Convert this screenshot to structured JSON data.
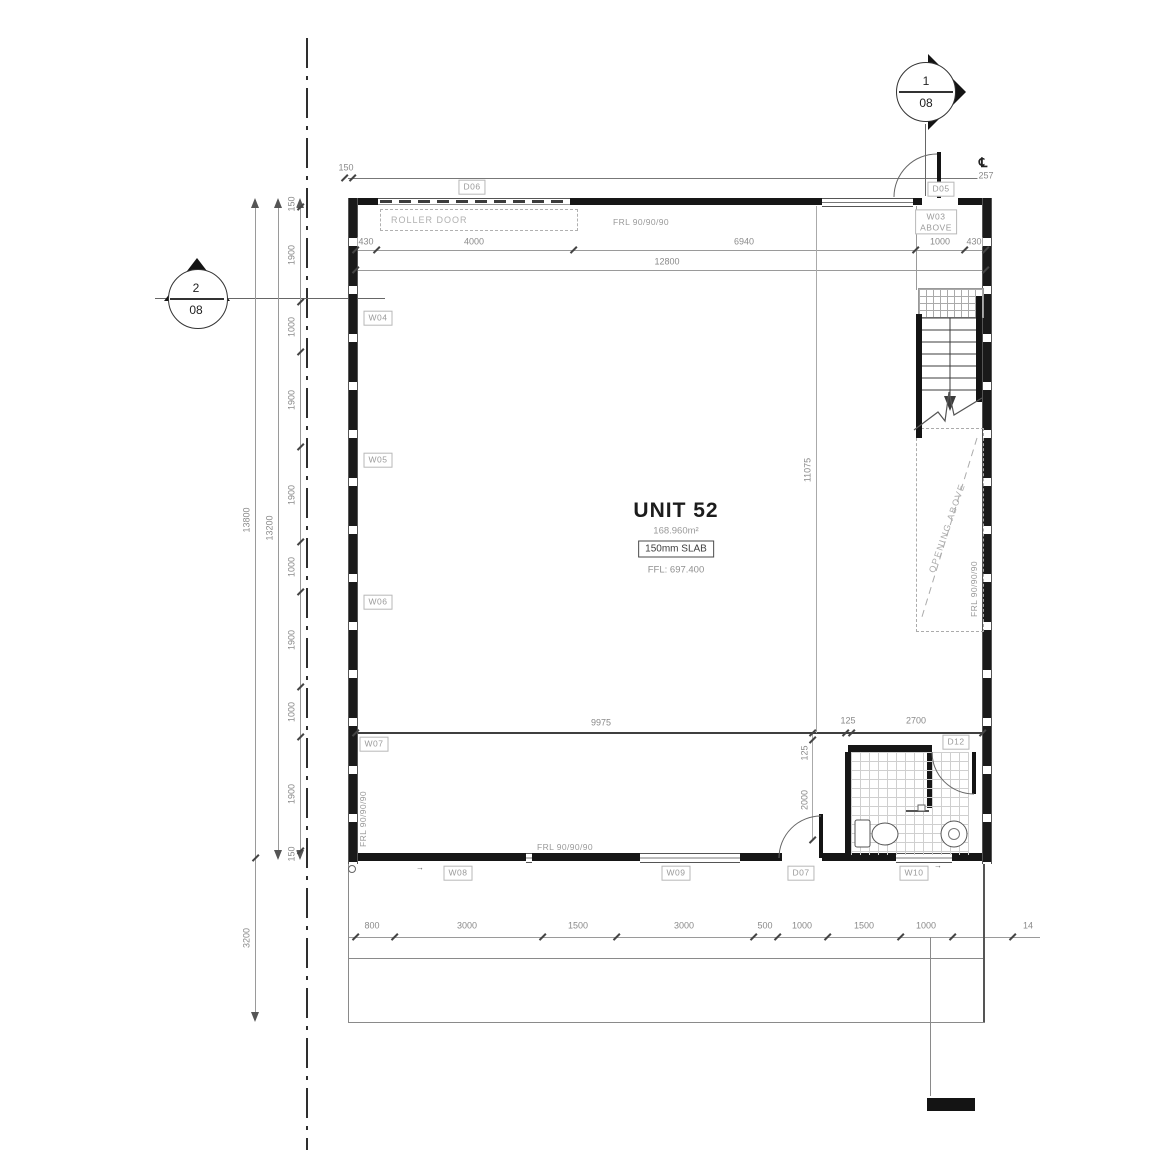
{
  "drawing": {
    "unit_name": "UNIT 52",
    "unit_area": "168.960m²",
    "slab_note": "150mm SLAB",
    "ffl_note": "FFL: 697.400",
    "roller_door": "ROLLER DOOR",
    "opening_above": "OPENING ABOVE",
    "centerline_symbol": "℄",
    "centerline_dim": "257",
    "frl_rating": "FRL 90/90/90"
  },
  "section_markers": {
    "top": {
      "number": "1",
      "sheet": "08"
    },
    "left": {
      "number": "2",
      "sheet": "08"
    }
  },
  "wall_tag_w03": {
    "text": "W03\nABOVE"
  },
  "tags": [
    {
      "id": "D06",
      "text": "D06",
      "x": 472,
      "y": 187
    },
    {
      "id": "D05",
      "text": "D05",
      "x": 941,
      "y": 189
    },
    {
      "id": "W04",
      "text": "W04",
      "x": 378,
      "y": 318
    },
    {
      "id": "W05",
      "text": "W05",
      "x": 378,
      "y": 460
    },
    {
      "id": "W06",
      "text": "W06",
      "x": 378,
      "y": 602
    },
    {
      "id": "W07",
      "text": "W07",
      "x": 374,
      "y": 744
    },
    {
      "id": "W08",
      "text": "W08",
      "x": 458,
      "y": 873
    },
    {
      "id": "W09",
      "text": "W09",
      "x": 676,
      "y": 873
    },
    {
      "id": "D07",
      "text": "D07",
      "x": 801,
      "y": 873
    },
    {
      "id": "W10",
      "text": "W10",
      "x": 914,
      "y": 873
    },
    {
      "id": "D12",
      "text": "D12",
      "x": 956,
      "y": 742
    }
  ],
  "frl_notes": [
    {
      "text": "FRL 90/90/90",
      "x": 641,
      "y": 222,
      "rot": 0
    },
    {
      "text": "FRL 90/90/90",
      "x": 565,
      "y": 847,
      "rot": 0
    },
    {
      "text": "FRL 90/90/90",
      "x": 974,
      "y": 589,
      "rot": -90
    },
    {
      "text": "FRL 90/90/90",
      "x": 363,
      "y": 819,
      "rot": -90
    }
  ],
  "dimensions": [
    {
      "text": "150",
      "x": 346,
      "y": 168,
      "rot": 0
    },
    {
      "text": "430",
      "x": 366,
      "y": 242,
      "rot": 0
    },
    {
      "text": "4000",
      "x": 474,
      "y": 242,
      "rot": 0
    },
    {
      "text": "6940",
      "x": 744,
      "y": 242,
      "rot": 0
    },
    {
      "text": "1000",
      "x": 940,
      "y": 242,
      "rot": 0
    },
    {
      "text": "430",
      "x": 974,
      "y": 242,
      "rot": 0
    },
    {
      "text": "12800",
      "x": 667,
      "y": 262,
      "rot": 0
    },
    {
      "text": "257",
      "x": 986,
      "y": 176,
      "rot": 0
    },
    {
      "text": "150",
      "x": 292,
      "y": 204,
      "rot": -90
    },
    {
      "text": "1900",
      "x": 292,
      "y": 255,
      "rot": -90
    },
    {
      "text": "1000",
      "x": 292,
      "y": 327,
      "rot": -90
    },
    {
      "text": "1900",
      "x": 292,
      "y": 400,
      "rot": -90
    },
    {
      "text": "1900",
      "x": 292,
      "y": 495,
      "rot": -90
    },
    {
      "text": "1000",
      "x": 292,
      "y": 567,
      "rot": -90
    },
    {
      "text": "1900",
      "x": 292,
      "y": 640,
      "rot": -90
    },
    {
      "text": "1000",
      "x": 292,
      "y": 712,
      "rot": -90
    },
    {
      "text": "1900",
      "x": 292,
      "y": 794,
      "rot": -90
    },
    {
      "text": "150",
      "x": 292,
      "y": 854,
      "rot": -90
    },
    {
      "text": "13800",
      "x": 247,
      "y": 520,
      "rot": -90
    },
    {
      "text": "13200",
      "x": 270,
      "y": 528,
      "rot": -90
    },
    {
      "text": "3200",
      "x": 247,
      "y": 938,
      "rot": -90
    },
    {
      "text": "9975",
      "x": 601,
      "y": 723,
      "rot": 0
    },
    {
      "text": "11075",
      "x": 808,
      "y": 470,
      "rot": -90
    },
    {
      "text": "125",
      "x": 848,
      "y": 721,
      "rot": 0
    },
    {
      "text": "2700",
      "x": 916,
      "y": 721,
      "rot": 0
    },
    {
      "text": "125",
      "x": 805,
      "y": 753,
      "rot": -90
    },
    {
      "text": "2000",
      "x": 805,
      "y": 800,
      "rot": -90
    },
    {
      "text": "800",
      "x": 372,
      "y": 926,
      "rot": 0
    },
    {
      "text": "3000",
      "x": 467,
      "y": 926,
      "rot": 0
    },
    {
      "text": "1500",
      "x": 578,
      "y": 926,
      "rot": 0
    },
    {
      "text": "3000",
      "x": 684,
      "y": 926,
      "rot": 0
    },
    {
      "text": "500",
      "x": 765,
      "y": 926,
      "rot": 0
    },
    {
      "text": "1000",
      "x": 802,
      "y": 926,
      "rot": 0
    },
    {
      "text": "1500",
      "x": 864,
      "y": 926,
      "rot": 0
    },
    {
      "text": "1000",
      "x": 926,
      "y": 926,
      "rot": 0
    },
    {
      "text": "14",
      "x": 1028,
      "y": 926,
      "rot": 0
    }
  ]
}
